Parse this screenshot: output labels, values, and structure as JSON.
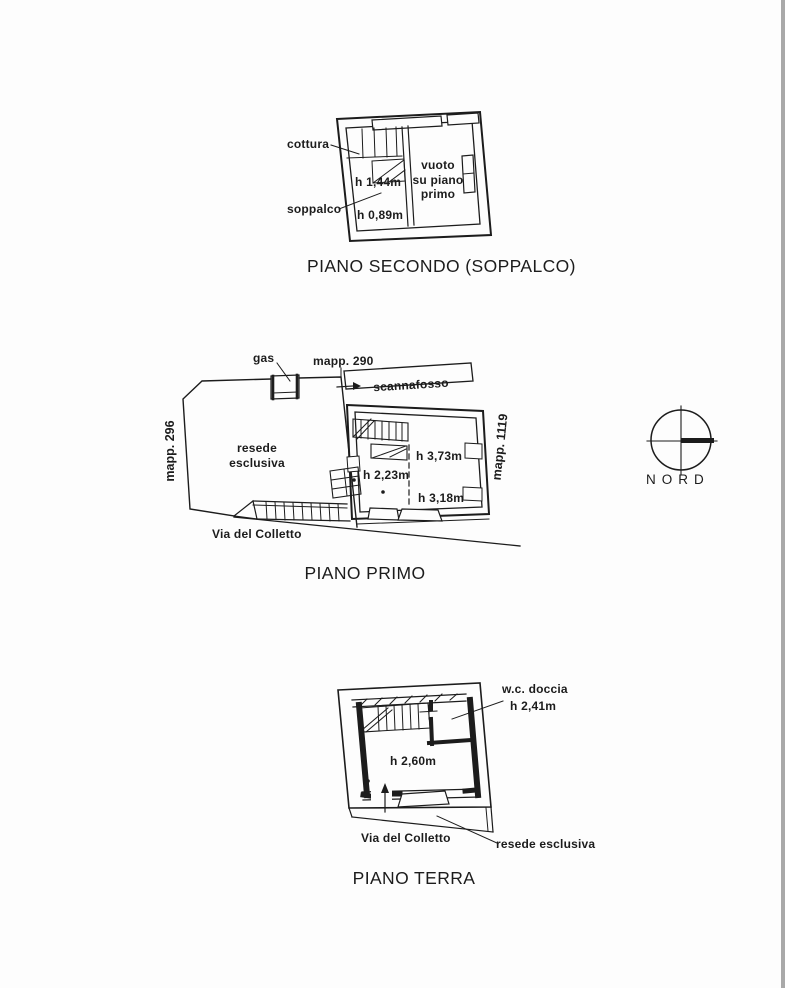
{
  "page": {
    "background": "#fdfdfd",
    "ink": "#1c1c1c",
    "edge_strip": "#a9a9a9"
  },
  "compass": {
    "label": "NORD"
  },
  "piano_secondo": {
    "title": "PIANO SECONDO (SOPPALCO)",
    "room_void": {
      "line1": "vuoto",
      "line2": "su piano",
      "line3": "primo"
    },
    "labels": {
      "cottura": "cottura",
      "soppalco": "soppalco",
      "h_144": "h 1,44m",
      "h_089": "h 0,89m"
    }
  },
  "piano_primo": {
    "title": "PIANO PRIMO",
    "labels": {
      "gas": "gas",
      "mapp_290": "mapp. 290",
      "mapp_296": "mapp. 296",
      "mapp_1119": "mapp. 1119",
      "scannafosso": "scannafosso",
      "resede_line1": "resede",
      "resede_line2": "esclusiva",
      "h_373": "h 3,73m",
      "h_223": "h 2,23m",
      "h_318": "h 3,18m",
      "street": "Via del Colletto"
    }
  },
  "piano_terra": {
    "title": "PIANO TERRA",
    "labels": {
      "wc": "w.c. doccia",
      "wc_height": "h 2,41m",
      "room_height": "h 2,60m",
      "street": "Via del Colletto",
      "resede": "resede esclusiva"
    }
  }
}
